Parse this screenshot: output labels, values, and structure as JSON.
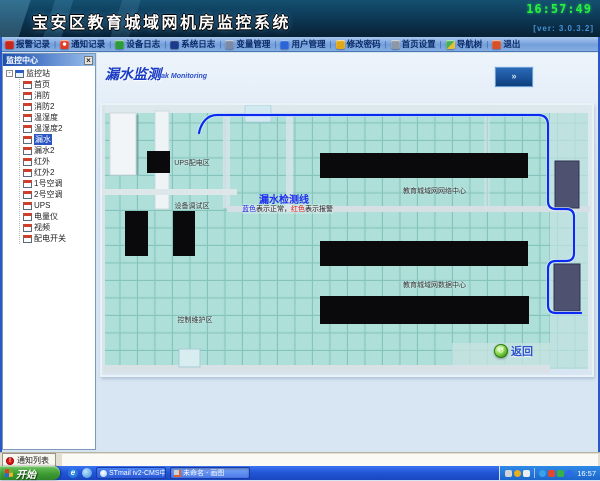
{
  "window": {
    "title": "宝安区教育城域网机房监控系统",
    "clock": "16:57:49",
    "version": "[ver: 3.0.3.2]"
  },
  "toolbar": {
    "separator": "|",
    "items": [
      {
        "label": "报警记录",
        "icon": "alarm-records-icon"
      },
      {
        "label": "通知记录",
        "icon": "notice-records-icon"
      },
      {
        "label": "设备日志",
        "icon": "device-log-icon"
      },
      {
        "label": "系统日志",
        "icon": "system-log-icon"
      },
      {
        "label": "变量管理",
        "icon": "variable-mgmt-icon"
      },
      {
        "label": "用户管理",
        "icon": "user-mgmt-icon"
      },
      {
        "label": "修改密码",
        "icon": "change-password-icon"
      },
      {
        "label": "首页设置",
        "icon": "homepage-settings-icon"
      },
      {
        "label": "导航树",
        "icon": "nav-tree-icon"
      },
      {
        "label": "退出",
        "icon": "exit-icon"
      }
    ]
  },
  "sidebar": {
    "title": "监控中心",
    "close_label": "×",
    "tree": {
      "expand_glyph": "-",
      "root": "监控站",
      "selected": "漏水",
      "items": [
        "首页",
        "消防",
        "消防2",
        "温湿度",
        "温湿度2",
        "漏水",
        "漏水2",
        "红外",
        "红外2",
        "1号空调",
        "2号空调",
        "UPS",
        "电量仪",
        "视频",
        "配电开关"
      ]
    }
  },
  "page": {
    "title": "漏水监测",
    "subtitle": "Leak Monitoring",
    "expand_button": "»"
  },
  "map": {
    "zones": {
      "ups": "UPS配电区",
      "debug": "设备调试区",
      "control": "控制维护区",
      "network_center": "教育城域网网络中心",
      "data_center": "教育城域网数据中心"
    },
    "legend": {
      "line_label": "漏水检测线",
      "blue_term": "蓝色",
      "blue_desc": "表示正常，",
      "red_term": "红色",
      "red_desc": "表示报警"
    },
    "back_button": {
      "icon": "back-orb-icon",
      "glyph": "↺",
      "label": "返回"
    },
    "colors": {
      "line_normal": "#0a2cf0",
      "alarm_text": "#e01818",
      "floor": "#a8dbd5",
      "rack": "#0a0a0c",
      "cabinet": "#4e5170"
    }
  },
  "statusbar": {
    "notify_tab": {
      "icon": "alert-icon",
      "glyph": "!",
      "label": "通知列表"
    }
  },
  "taskbar": {
    "start_label": "开始",
    "quick_launch": [
      "ie-icon",
      "show-desktop-icon"
    ],
    "tasks": [
      {
        "icon": "stmail-icon",
        "label": "STmail iv2-CMS中..."
      },
      {
        "icon": "paint-icon",
        "label": "未命名 - 画图",
        "active": true
      }
    ],
    "tray": {
      "icons": [
        "printer-icon",
        "update-icon",
        "volume-icon",
        "network-status-icon",
        "alarm-tray-icon",
        "antivirus-shield-icon",
        "messenger-icon"
      ],
      "time": "16:57"
    }
  }
}
